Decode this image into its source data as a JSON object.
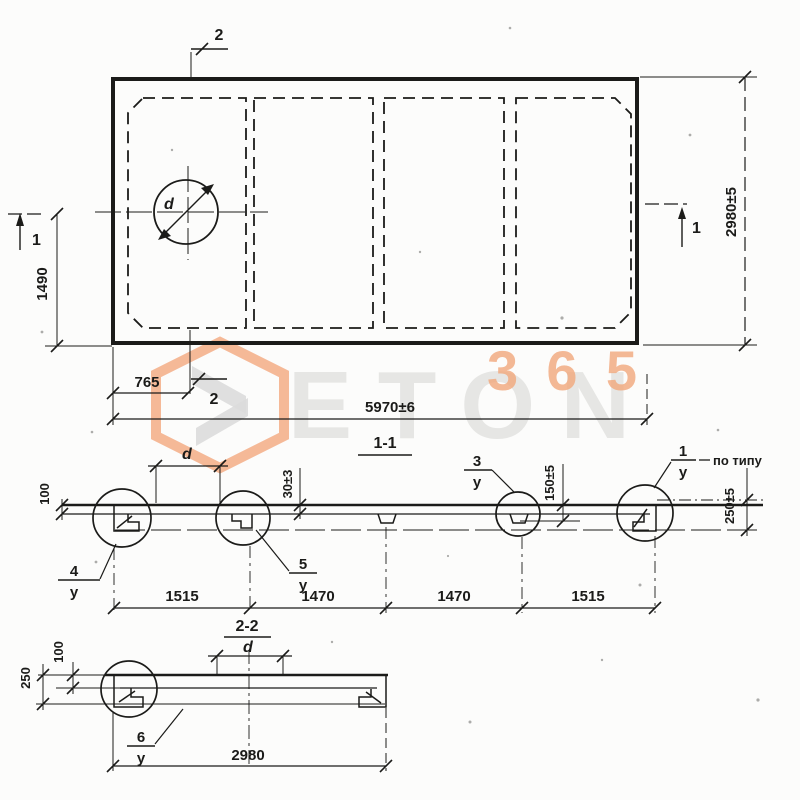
{
  "watermark": {
    "brand": "ETON",
    "badge": "365"
  },
  "plan": {
    "cut_top": "2",
    "cut_bottom": "2",
    "cut_left": "1",
    "cut_right": "1",
    "hole_dia": "d",
    "dim_left": "1490",
    "dim_hole": "765",
    "dim_length": "5970±6",
    "dim_width": "2980±5"
  },
  "sec1": {
    "title": "1-1",
    "dim_d": "d",
    "dim_t": "30±3",
    "dim_end": "100",
    "dim_rib": "150±5",
    "dim_edge": "250±5",
    "dim_b1": "1515",
    "dim_b2": "1470",
    "dim_b3": "1470",
    "dim_b4": "1515",
    "c4n": "4",
    "c4d": "у",
    "c5n": "5",
    "c5d": "у",
    "c3n": "3",
    "c3d": "у",
    "c1n": "1",
    "c1d": "у",
    "note": "по типу"
  },
  "sec2": {
    "title": "2-2",
    "dim_d": "d",
    "dim_top": "100",
    "dim_edge": "250",
    "dim_width": "2980",
    "c6n": "6",
    "c6d": "у"
  }
}
